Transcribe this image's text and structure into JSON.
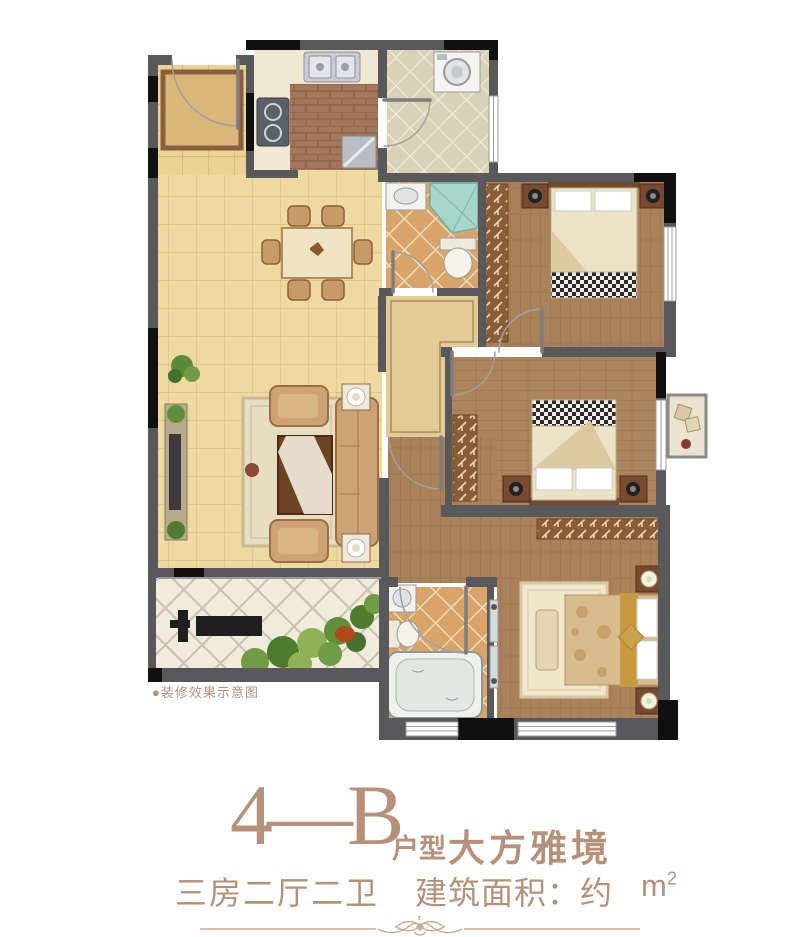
{
  "title": {
    "code": "4—B",
    "type_label": "户型",
    "name": "大方雅境"
  },
  "specs": {
    "rooms": "三房二厅二卫",
    "area_label": "建筑面积：约",
    "unit_base": "m",
    "unit_sup": "2"
  },
  "plan": {
    "caption": "●装修效果示意图"
  },
  "colors": {
    "text_brown": "#b5917a",
    "wall_gray": "#59595b",
    "wall_black": "#101010",
    "floor_marble": "#eed9a0",
    "floor_wood": "#a9825a",
    "tile_orange": "#d9a469",
    "tile_laundry": "#d9d2b6",
    "garden_tile": "#efebdd",
    "shower_glass": "#a7d7c9",
    "greenery": "#5f8f3a",
    "window_white": "#ffffff"
  }
}
